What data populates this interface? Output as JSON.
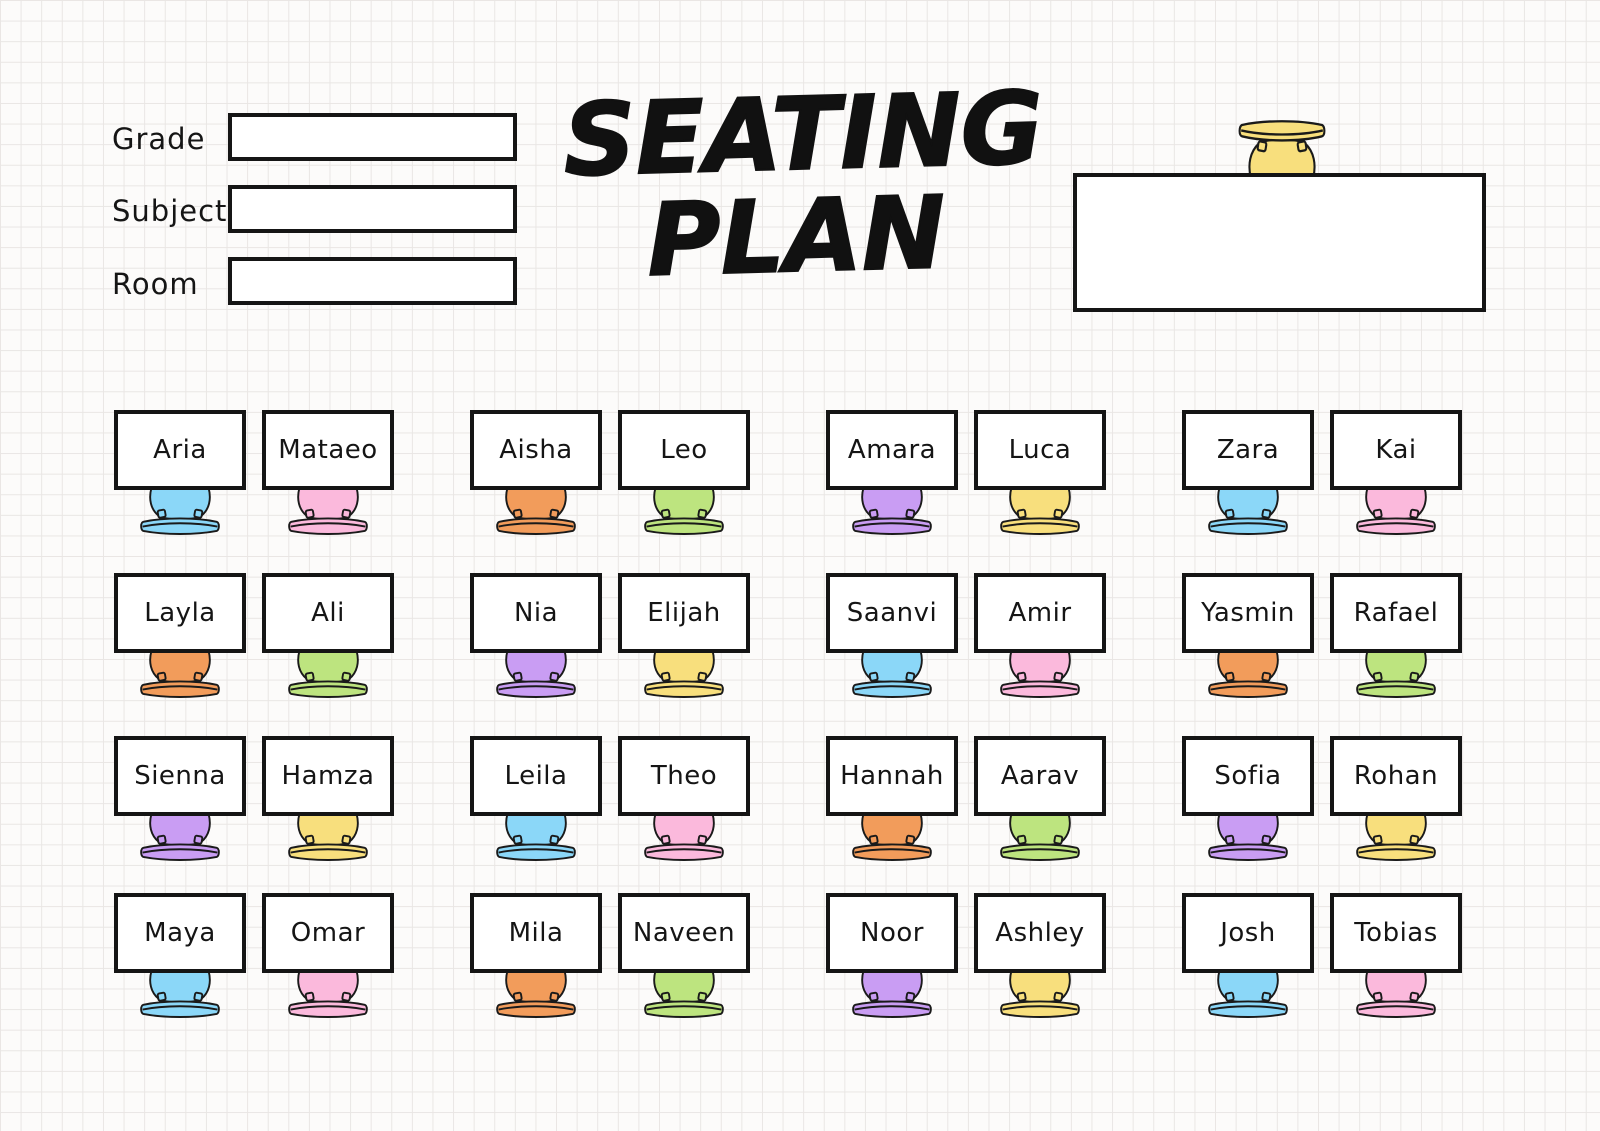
{
  "title": {
    "line1": "SEATING",
    "line2": "PLAN"
  },
  "form": {
    "fields": [
      {
        "label": "Grade",
        "value": ""
      },
      {
        "label": "Subject",
        "value": ""
      },
      {
        "label": "Room",
        "value": ""
      }
    ]
  },
  "teacher_desk": {
    "label": "",
    "chair_color": "yellow"
  },
  "chair_colors": {
    "blue": "#8BD7F8",
    "pink": "#FBB9DC",
    "orange": "#F29C5B",
    "green": "#BDE47F",
    "purple": "#C99DF3",
    "yellow": "#F8DF7D"
  },
  "rows": [
    {
      "seats": [
        {
          "name": "Aria",
          "color": "blue"
        },
        {
          "name": "Mataeo",
          "color": "pink"
        },
        {
          "name": "Aisha",
          "color": "orange"
        },
        {
          "name": "Leo",
          "color": "green"
        },
        {
          "name": "Amara",
          "color": "purple"
        },
        {
          "name": "Luca",
          "color": "yellow"
        },
        {
          "name": "Zara",
          "color": "blue"
        },
        {
          "name": "Kai",
          "color": "pink"
        }
      ]
    },
    {
      "seats": [
        {
          "name": "Layla",
          "color": "orange"
        },
        {
          "name": "Ali",
          "color": "green"
        },
        {
          "name": "Nia",
          "color": "purple"
        },
        {
          "name": "Elijah",
          "color": "yellow"
        },
        {
          "name": "Saanvi",
          "color": "blue"
        },
        {
          "name": "Amir",
          "color": "pink"
        },
        {
          "name": "Yasmin",
          "color": "orange"
        },
        {
          "name": "Rafael",
          "color": "green"
        }
      ]
    },
    {
      "seats": [
        {
          "name": "Sienna",
          "color": "purple"
        },
        {
          "name": "Hamza",
          "color": "yellow"
        },
        {
          "name": "Leila",
          "color": "blue"
        },
        {
          "name": "Theo",
          "color": "pink"
        },
        {
          "name": "Hannah",
          "color": "orange"
        },
        {
          "name": "Aarav",
          "color": "green"
        },
        {
          "name": "Sofia",
          "color": "purple"
        },
        {
          "name": "Rohan",
          "color": "yellow"
        }
      ]
    },
    {
      "seats": [
        {
          "name": "Maya",
          "color": "blue"
        },
        {
          "name": "Omar",
          "color": "pink"
        },
        {
          "name": "Mila",
          "color": "orange"
        },
        {
          "name": "Naveen",
          "color": "green"
        },
        {
          "name": "Noor",
          "color": "purple"
        },
        {
          "name": "Ashley",
          "color": "yellow"
        },
        {
          "name": "Josh",
          "color": "blue"
        },
        {
          "name": "Tobias",
          "color": "pink"
        }
      ]
    }
  ]
}
